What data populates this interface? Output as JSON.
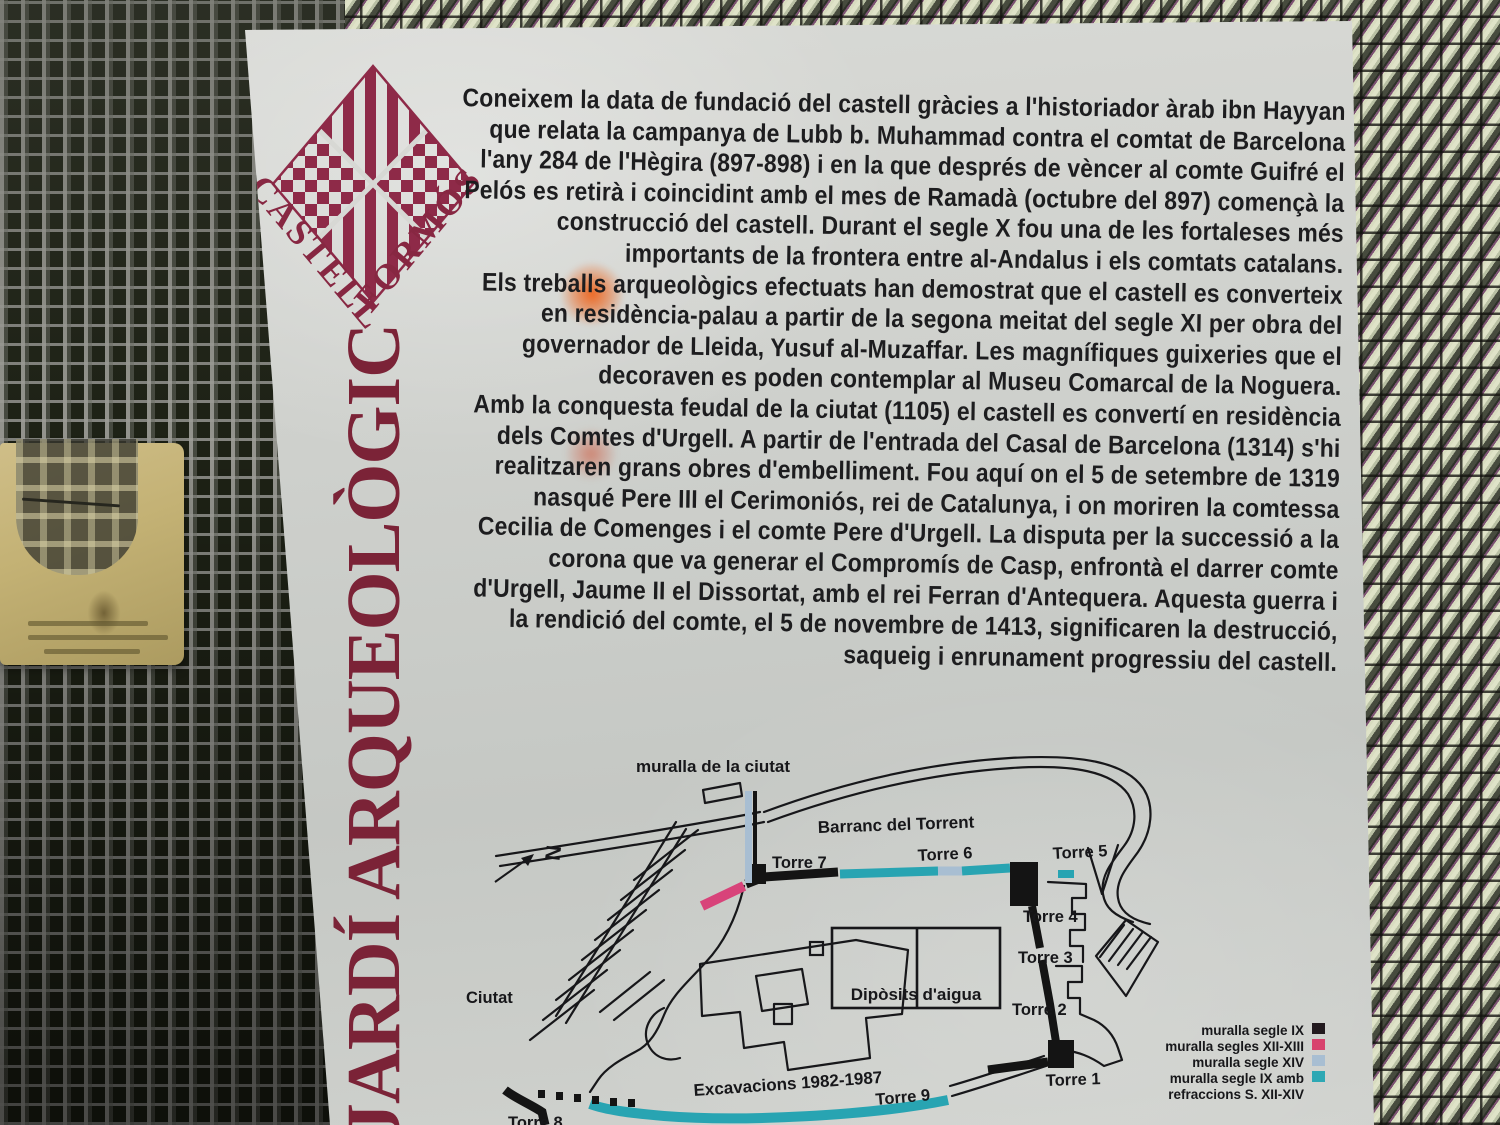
{
  "sign": {
    "logo": {
      "word1": "CASTELL",
      "word2": "FORMÓS"
    },
    "vertical_title": "JARDÍ ARQUEOLÒGIC",
    "paragraphs": [
      "Coneixem la data de fundació del castell gràcies a l'historiador àrab ibn Hayyan que relata la campanya de Lubb b. Muhammad contra el comtat de Barcelona l'any 284 de l'Hègira (897-898) i en la que després de vèncer al comte Guifré el Pelós es retirà i coincidint amb el mes de Ramadà (octubre del 897) començà la construcció del castell. Durant el segle X fou una de les fortaleses més importants de la frontera entre al-Andalus i els comtats catalans.",
      "Els treballs arqueològics efectuats han demostrat que el castell es converteix en residència-palau a partir de la segona meitat del segle XI per obra del governador de Lleida, Yusuf al-Muzaffar. Les magnífiques guixeries que el decoraven es poden contemplar al Museu Comarcal de la Noguera.",
      "Amb la conquesta feudal de la ciutat (1105) el castell es convertí en residència dels Comtes d'Urgell. A partir de l'entrada del Casal de Barcelona (1314) s'hi realitzaren grans obres d'embelliment. Fou aquí on el 5 de setembre de 1319 nasqué Pere III el Cerimoniós, rei de Catalunya, i on moriren la comtessa Cecilia de Comenges i el comte Pere d'Urgell. La disputa per la successió a la corona que va generar el Compromís de Casp, enfrontà el darrer comte d'Urgell, Jaume II el Dissortat, amb el rei Ferran d'Antequera. Aquesta guerra i la rendició del comte, el 5 de novembre de 1413, significaren la destrucció, saqueig i enrunament progressiu del castell."
    ]
  },
  "map": {
    "labels": {
      "city_wall": "muralla de la ciutat",
      "ravine": "Barranc del Torrent",
      "towers": [
        "Torre 7",
        "Torre 6",
        "Torre 5",
        "Torre 4",
        "Torre 3",
        "Torre 2",
        "Torre 1",
        "Torre 9",
        "Torre 8"
      ],
      "city": "Ciutat",
      "water_tanks": "Dipòsits d'aigua",
      "excavations": "Excavacions 1982-1987",
      "north": "N"
    },
    "legend": {
      "items": [
        {
          "label": "muralla segle IX",
          "color": "#221a1e"
        },
        {
          "label": "muralla segles XII-XIII",
          "color": "#d8436e"
        },
        {
          "label": "muralla segle XIV",
          "color": "#a8bed2"
        },
        {
          "label": "muralla segle IX amb",
          "color": "#2ea8b4"
        },
        {
          "label": "refraccions S. XII-XIV",
          "color": ""
        }
      ]
    }
  },
  "colors": {
    "emblem_maroon": "#872742",
    "title_maroon": "#7b2337",
    "wall_black": "#141414",
    "wall_pink": "#d8437a",
    "wall_lightblue": "#a8bed2",
    "wall_teal": "#28a4b2"
  }
}
